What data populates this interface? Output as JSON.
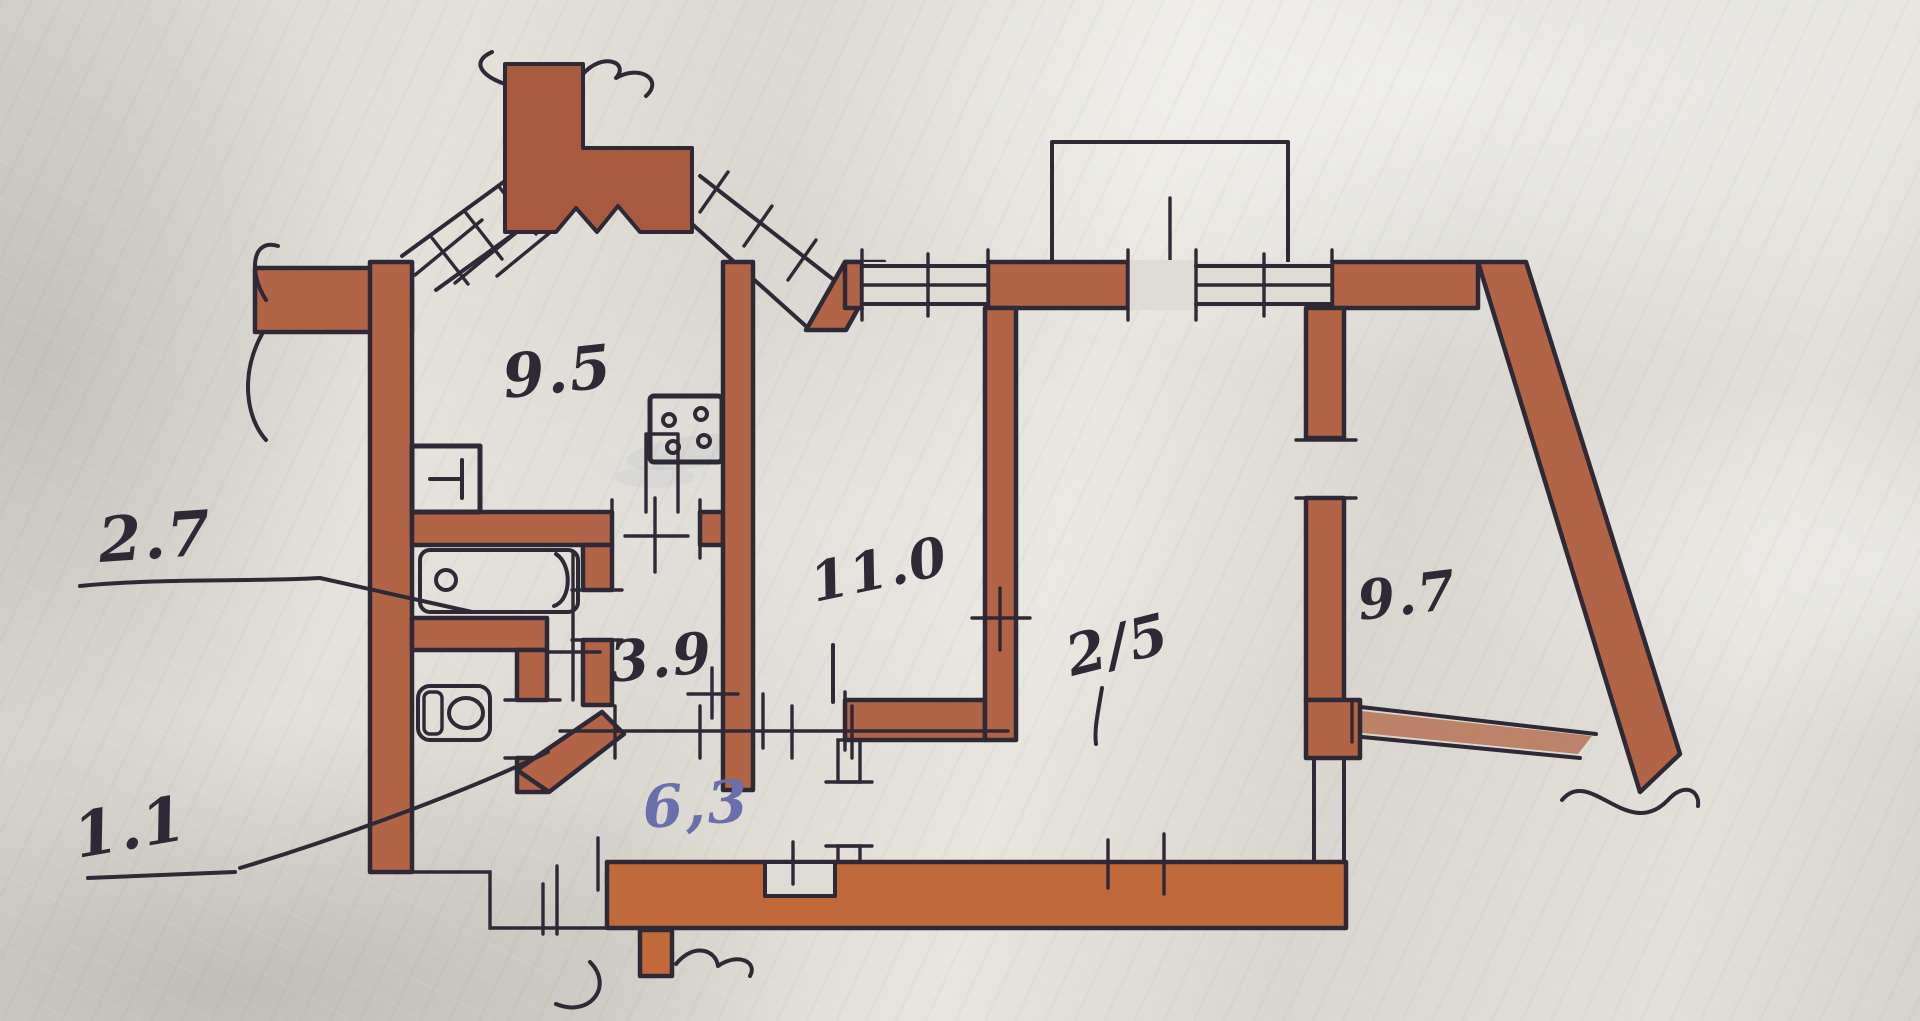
{
  "floor_plan": {
    "labels": {
      "kitchen": "9.5",
      "bathroom": "2.7",
      "toilet": "1.1",
      "hallway": "3.9",
      "corridor": "6,3",
      "bedroom": "11.0",
      "living_room": "2/5",
      "bedroom_right": "9.7"
    },
    "annotations": {
      "bathroom_label_has_leader_line": true,
      "toilet_label_has_leader_line": true,
      "corridor_label_ink": "blue"
    },
    "colors": {
      "wall": "#b26546",
      "wall-bright": "#c06a3c",
      "wall-deep": "#a85a3e",
      "ink": "#2f2936",
      "blue-ink": "#6b6fa9",
      "paper": "#dedcd5"
    }
  }
}
